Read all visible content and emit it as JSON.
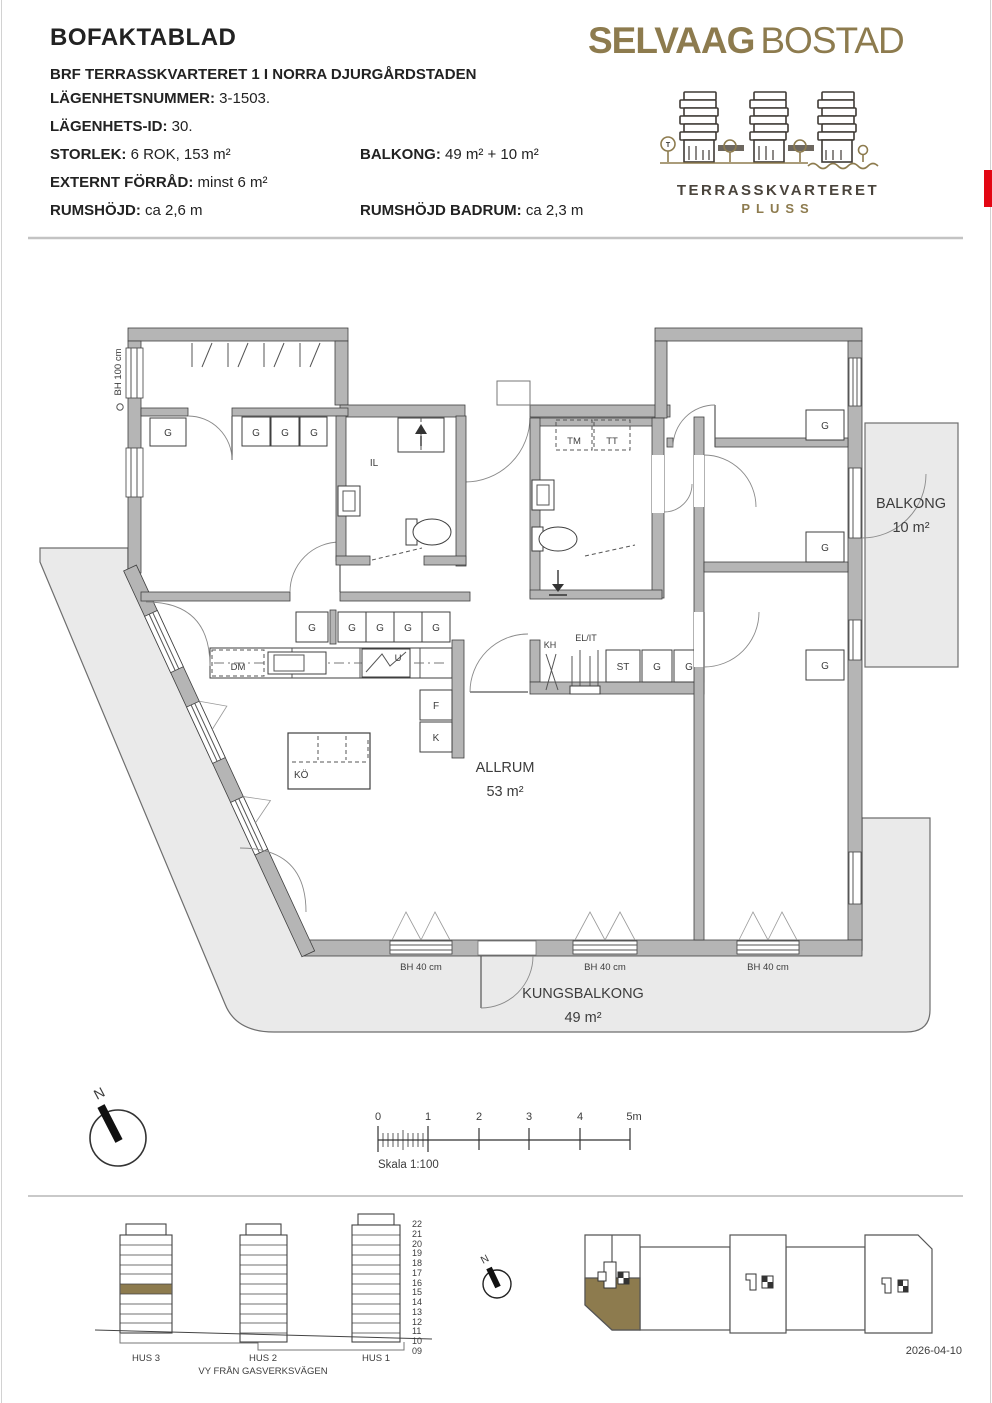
{
  "header": {
    "title": "BOFAKTABLAD",
    "subtitle": "BRF TERRASSKVARTERET 1 I NORRA DJURGÅRDSTADEN",
    "fields": [
      {
        "label": "LÄGENHETSNUMMER:",
        "value": "3-1503."
      },
      {
        "label": "LÄGENHETS-ID:",
        "value": "30."
      },
      {
        "label": "STORLEK:",
        "value": "6 ROK, 153 m²"
      },
      {
        "label": "BALKONG:",
        "value": "49 m² + 10 m²"
      },
      {
        "label": "EXTERNT FÖRRÅD:",
        "value": "minst 6 m²"
      },
      {
        "label": "RUMSHÖJD:",
        "value": "ca 2,6 m"
      },
      {
        "label": "RUMSHÖJD BADRUM:",
        "value": "ca 2,3 m"
      }
    ]
  },
  "logo": {
    "brand_bold": "SELVAAG",
    "brand_light": "BOSTAD",
    "project_name": "TERRASSKVARTERET",
    "project_sub": "PLUSS"
  },
  "colors": {
    "gold": "#8d7b4e",
    "red_tab": "#e30613",
    "wall_gray": "#b5b5b5",
    "balcony_gray": "#eaeaea"
  },
  "floorplan": {
    "bh100": "BH 100 cm",
    "bh40": "BH 40 cm",
    "g": "G",
    "il": "IL",
    "tm": "TM",
    "tt": "TT",
    "kh": "KH",
    "elit": "EL/IT",
    "st": "ST",
    "dm": "DM",
    "u": "U",
    "f": "F",
    "k": "K",
    "ko": "KÖ",
    "allrum": "ALLRUM",
    "allrum_area": "53 m²",
    "balkong": "BALKONG",
    "balkong_area": "10 m²",
    "kungsbalkong": "KUNGSBALKONG",
    "kungsbalkong_area": "49 m²"
  },
  "compass": {
    "n": "N"
  },
  "scalebar": {
    "ticks": [
      "0",
      "1",
      "2",
      "3",
      "4",
      "5m"
    ],
    "caption": "Skala 1:100"
  },
  "elevation": {
    "floors": [
      "22",
      "21",
      "20",
      "19",
      "18",
      "17",
      "16",
      "15",
      "14",
      "13",
      "12",
      "11",
      "10",
      "09"
    ],
    "hus3": "HUS 3",
    "hus2": "HUS 2",
    "hus1": "HUS 1",
    "caption": "VY FRÅN GASVERKSVÄGEN"
  },
  "footer": {
    "date": "2026-04-10"
  }
}
